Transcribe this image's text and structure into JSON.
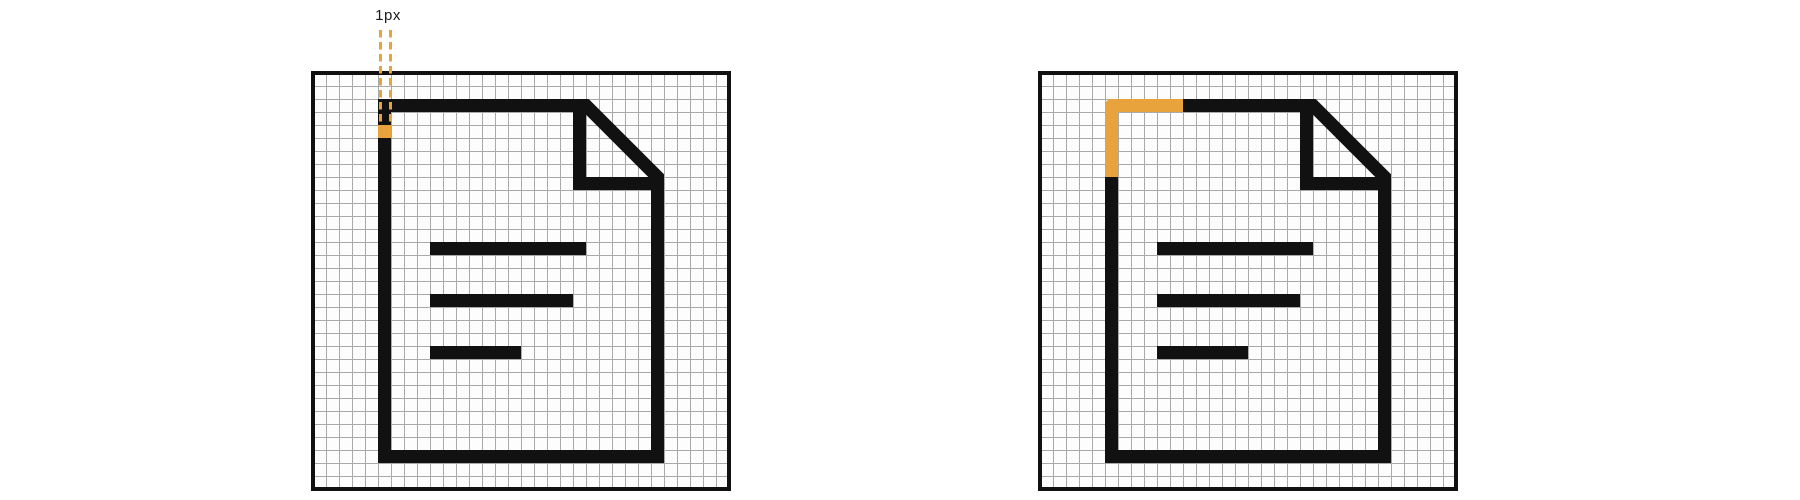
{
  "figure": {
    "pixel_width_label": "1px"
  },
  "colors": {
    "highlight_orange": "#E8A33C",
    "icon_black": "#111111",
    "grid_line": "#A9A9A9",
    "grid_cell_background": "#FDFDFD",
    "page_background": "#FFFFFF"
  },
  "grid": {
    "columns": 32,
    "rows": 32,
    "cell_size_px": 13
  }
}
